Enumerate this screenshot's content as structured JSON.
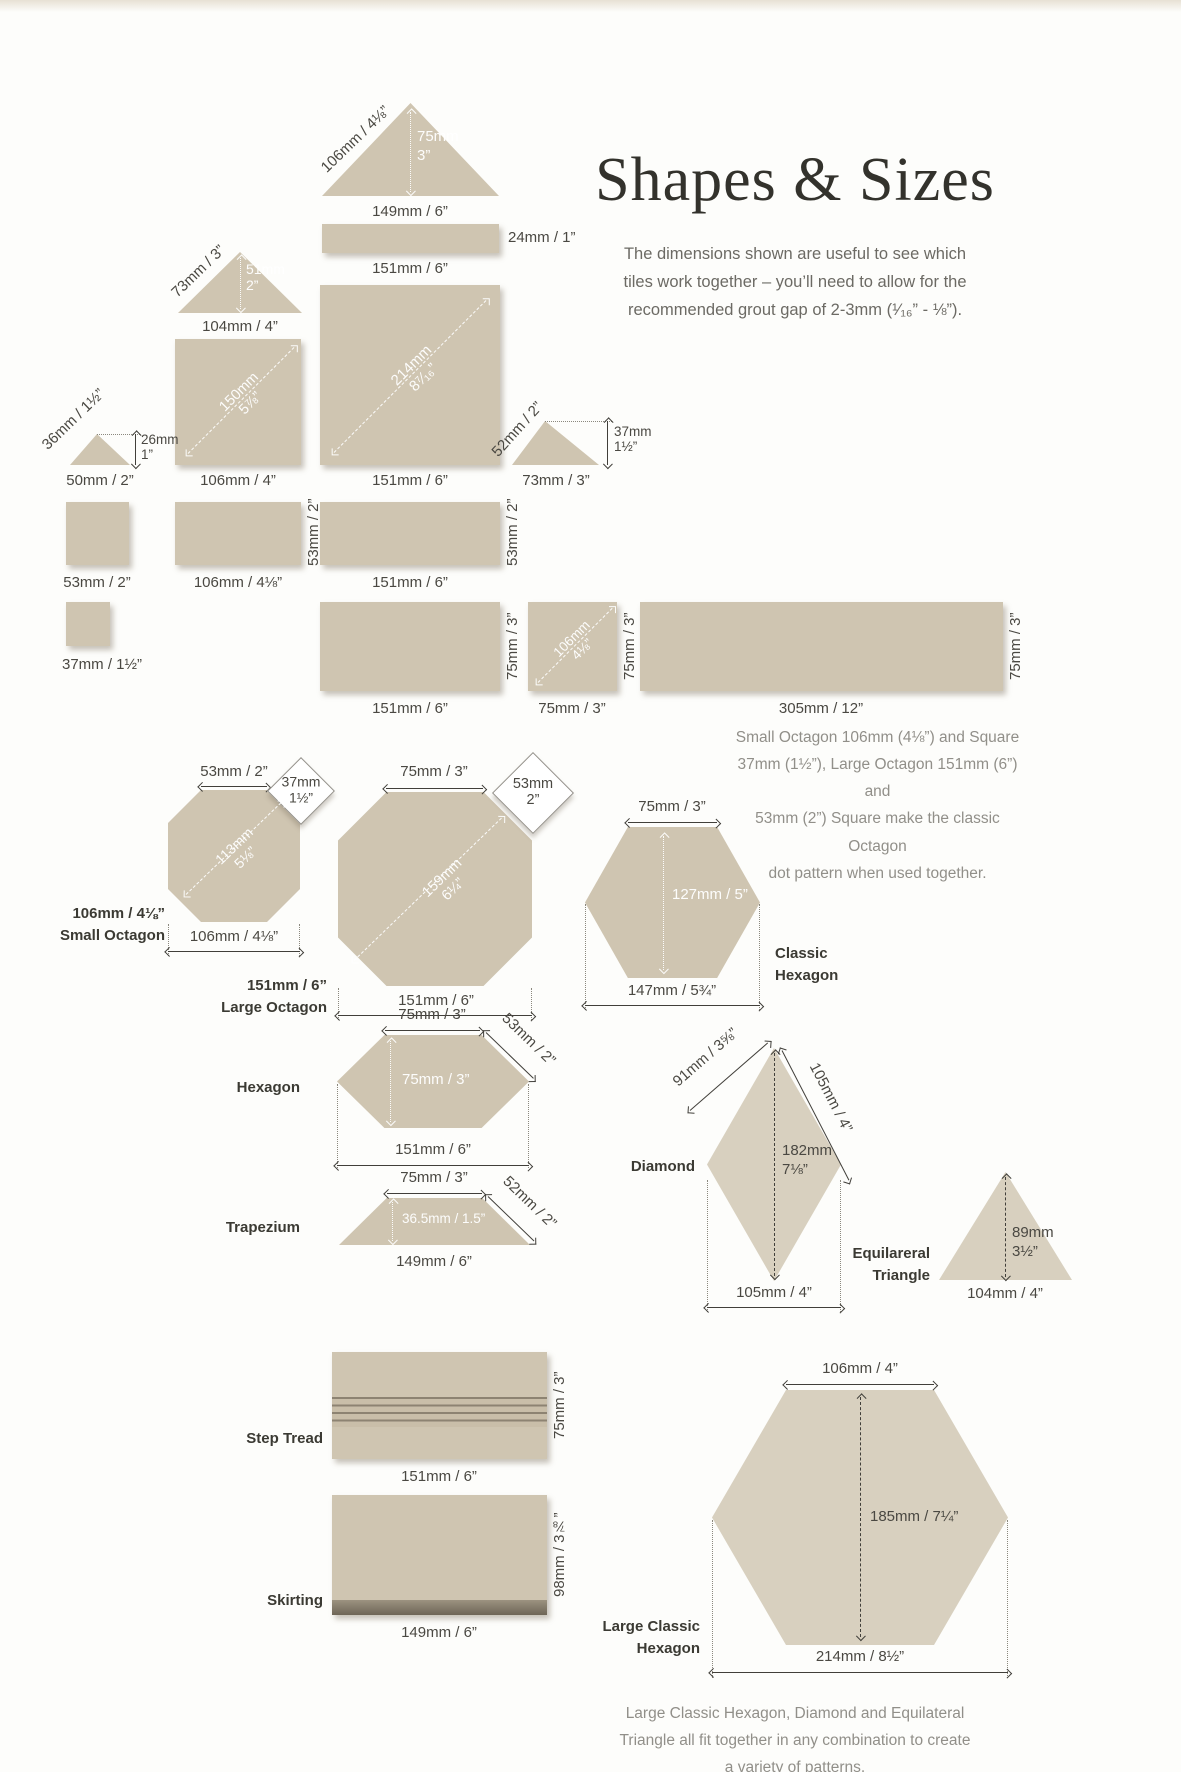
{
  "header": {
    "title": "Shapes & Sizes",
    "intro": "The dimensions shown are useful to see which\ntiles work together – you’ll need to allow for the\nrecommended grout gap of 2-3mm (¹⁄₁₆” - ⅛”)."
  },
  "notes": {
    "octagon_dot": "Small Octagon 106mm (4⅛”) and Square\n37mm (1½”), Large Octagon 151mm (6”) and\n53mm (2”) Square make the classic Octagon\ndot pattern when used together.",
    "fit_together": "Large Classic Hexagon, Diamond and Equilateral\nTriangle all fit together in any combination to create\na variety of patterns."
  },
  "colors": {
    "tile_beige": "#cfc5b1",
    "tile_light": "#d8d0bf",
    "dimension_ink": "#413f3a",
    "muted_text": "#918f89",
    "background": "#fdfdfb"
  },
  "figures": {
    "triangle_149": {
      "side": "106mm / 4⅛”",
      "height": "75mm\n3”",
      "base": "149mm / 6”"
    },
    "strip_24": {
      "height": "24mm / 1”",
      "base": "151mm / 6”"
    },
    "square_151": {
      "diagonal": "214mm\n8⁷⁄₁₆”",
      "base": "151mm / 6”"
    },
    "triangle_104": {
      "side": "73mm / 3”",
      "height": "51mm\n2”",
      "base": "104mm / 4”"
    },
    "square_106": {
      "diagonal": "150mm\n5⅞”",
      "base": "106mm / 4”"
    },
    "triangle_50": {
      "side": "36mm / 1½”",
      "height": "26mm\n1”",
      "base": "50mm / 2”"
    },
    "triangle_73": {
      "side": "52mm / 2”",
      "height": "37mm\n1½”",
      "base": "73mm / 3”"
    },
    "square_53": {
      "base": "53mm / 2”"
    },
    "rect_106x53": {
      "side": "53mm / 2”",
      "base": "106mm / 4⅛”"
    },
    "rect_151x53": {
      "side": "53mm / 2”",
      "base": "151mm / 6”"
    },
    "square_37": {
      "base": "37mm / 1½”"
    },
    "rect_151x75": {
      "side": "75mm / 3”",
      "base": "151mm / 6”"
    },
    "square_75": {
      "diagonal": "106mm\n4⅛”",
      "side": "75mm / 3”",
      "base": "75mm / 3”"
    },
    "rect_305x75": {
      "side": "75mm / 3”",
      "base": "305mm / 12”"
    },
    "small_octagon": {
      "top": "53mm / 2”",
      "dot": "37mm\n1½”",
      "diagonal": "113mm\n5⅛”",
      "width": "106mm / 4⅛”",
      "label": "106mm / 4⅛”\nSmall Octagon"
    },
    "large_octagon": {
      "top": "75mm / 3”",
      "dot": "53mm\n2”",
      "diagonal": "159mm\n6¼”",
      "width": "151mm / 6”",
      "label": "151mm / 6”\nLarge Octagon"
    },
    "classic_hexagon": {
      "top": "75mm / 3”",
      "height": "127mm / 5”",
      "width": "147mm / 5¾”",
      "label": "Classic\nHexagon"
    },
    "hexagon": {
      "top": "75mm / 3”",
      "slant": "53mm / 2”",
      "height": "75mm / 3”",
      "width": "151mm / 6”",
      "label": "Hexagon"
    },
    "trapezium": {
      "top": "75mm / 3”",
      "slant": "52mm / 2”",
      "height": "36.5mm / 1.5”",
      "base": "149mm / 6”",
      "label": "Trapezium"
    },
    "diamond": {
      "side_left": "91mm / 3⅝”",
      "side_right": "105mm / 4”",
      "height": "182mm\n7⅛”",
      "width": "105mm / 4”",
      "label": "Diamond"
    },
    "equilateral_triangle": {
      "height": "89mm\n3½”",
      "base": "104mm / 4”",
      "label": "Equilareral\nTriangle"
    },
    "step_tread": {
      "side": "75mm / 3”",
      "base": "151mm / 6”",
      "label": "Step Tread"
    },
    "skirting": {
      "side": "98mm / 3⅞”",
      "base": "149mm / 6”",
      "label": "Skirting"
    },
    "large_classic_hexagon": {
      "top": "106mm / 4”",
      "height": "185mm / 7¼”",
      "width": "214mm / 8½”",
      "label": "Large Classic\nHexagon"
    }
  }
}
